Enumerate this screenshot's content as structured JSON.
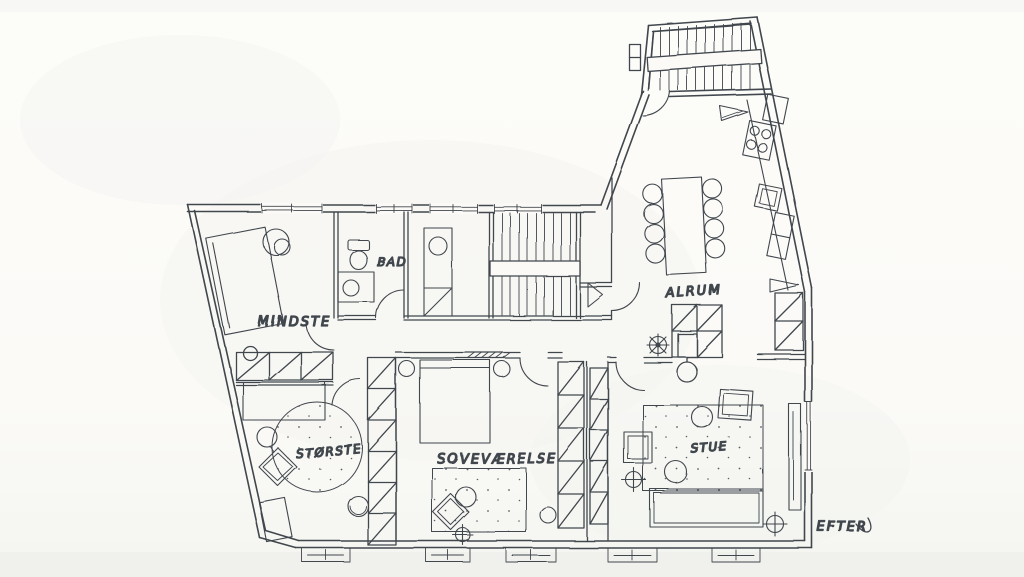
{
  "labels": {
    "mindste": "MINDSTE",
    "bad": "BAD",
    "storste": "STØRSTE",
    "sovevaerelse": "SOVEVÆRELSE",
    "alrum": "ALRUM",
    "stue": "STUE",
    "efter": "EFTER"
  },
  "colors": {
    "paper": "#fbfaf7",
    "ink": "#41464d",
    "label_ink": "#373c44"
  }
}
